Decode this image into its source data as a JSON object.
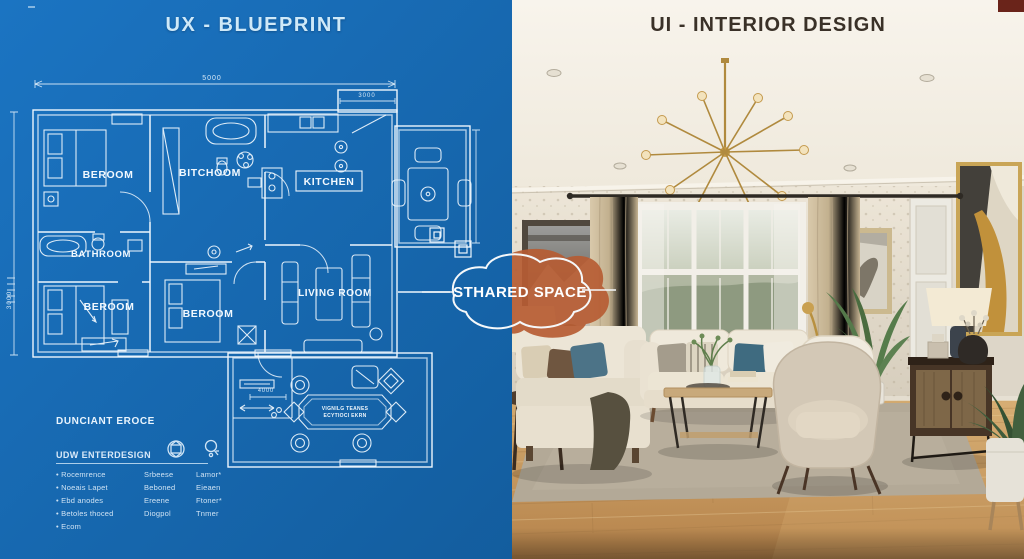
{
  "left_panel": {
    "title": "UX - BLUEPRINT",
    "colors": {
      "background": "#1569b4",
      "lines": "#eaf4fb"
    },
    "rooms": [
      {
        "id": "bedroom-top-left",
        "label": "BEROOM"
      },
      {
        "id": "bath-top",
        "label": "BITCHOOM"
      },
      {
        "id": "kitchen",
        "label": "KITCHEN"
      },
      {
        "id": "bathroom",
        "label": "BATHROOM"
      },
      {
        "id": "bedroom-bottom-left",
        "label": "BEROOM"
      },
      {
        "id": "bedroom-bottom-mid",
        "label": "BEROOM"
      },
      {
        "id": "living-room",
        "label": "LIVING ROOM"
      }
    ],
    "dimensions": {
      "top": "5000",
      "annex": "3000",
      "left": "3000",
      "entry": "4000"
    },
    "stamp": {
      "line1": "VIGNILG TEANES",
      "line2": "ECYTIOCI EKRN"
    },
    "legend": {
      "heading": "DUNCIANT EROCE",
      "subheading": "UDW ENTERDESIGN",
      "icons": [
        "cube-icon",
        "key-icon"
      ],
      "rows": [
        {
          "bullet": "Rocemrence",
          "col2": "Srbeese",
          "col3": "Lamor*"
        },
        {
          "bullet": "Noeais Lapet",
          "col2": "Beboned",
          "col3": "Eieaen"
        },
        {
          "bullet": "Ebd anodes",
          "col2": "Ereene",
          "col3": "Ftoner*"
        },
        {
          "bullet": "Betoles thoced",
          "col2": "Diogpol",
          "col3": "Tnmer"
        },
        {
          "bullet": "Ecom",
          "col2": "",
          "col3": ""
        }
      ]
    }
  },
  "center_badge": {
    "label": "STHARED SPACE",
    "colors": {
      "blob": "#b65c33",
      "outline": "#f5f8fa"
    }
  },
  "right_panel": {
    "title": "UI - INTERIOR DESIGN",
    "colors": {
      "wall": "#ddd5c6",
      "ceiling": "#f6f1e8",
      "floor": "#c39a5f",
      "rug": "#b3a997",
      "sofa": "#ece5d6",
      "accent_pillow": "#3f6b80",
      "chandelier": "#c69c46"
    }
  }
}
